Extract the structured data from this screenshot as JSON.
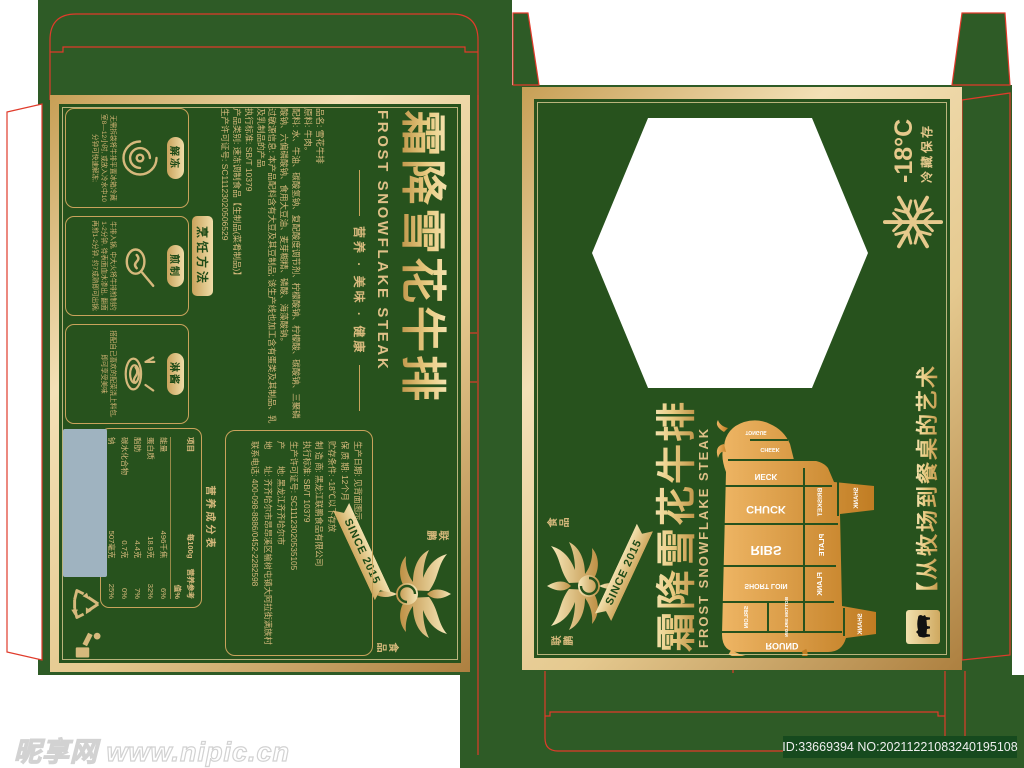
{
  "watermarks": {
    "site": "昵享网 www.nipic.cn",
    "stock_id": "ID:33669394 NO:20211221083240195108"
  },
  "brand": {
    "zh_top": "联鹏",
    "zh_bottom": "食品",
    "since": "SINCE 2015"
  },
  "back": {
    "title": "霜降雪花牛排",
    "subtitle": "FROST SNOWFLAKE STEAK",
    "slogan": "营养 · 美味 · 健康",
    "info": "品名: 雪花牛排\n原料: 牛肉。\n配料: 水、牛油、碳酸氢钠、复配酸度调节剂、柠檬酸钠、柠檬酸、碳酸钠、三聚磷酸钠、六偏磷酸钠、食用大豆油、麦芽糊精、磷酸、海藻酸钠。\n过敏源信息: 本产品配料含有大豆及其豆制品; 该生产线也加工含有蛋类及其制品、乳及乳制品的产品\n执行标准: SB/T 10379\n产品类别: 速冻调制食品【生制品(菜肴制品)】\n生产许可证号: SC11123020506529",
    "manufacturer": "生产日期: 见背面图示\n保 质 期: 12个月\n贮存条件: -18℃以下存放\n制 造 商: 黑龙江联鹏食品有限公司\n执行标准: SB/T 10379\n生产许可证号: SC11123020535105\n产　　地: 黑龙江齐齐哈尔市\n地　　址: 齐齐哈尔市昂昂溪区榆树屯镇大阿拉街满族村\n联系电话: 400-098-8886/0452-2282598",
    "cooking_label": "烹饪方法",
    "steps": [
      {
        "name": "解冻",
        "text": "无需拆袋将牛排平置冰箱冷藏室8—12小时, 或放入冷水中10分钟可快速解冻;"
      },
      {
        "name": "煎制",
        "text": "牛排入锅, 中大火将牛排煎制约1-2分钟, 待表面血水渗出, 翻面再煎1-2分钟, 约7成熟即可出锅;"
      },
      {
        "name": "淋酱",
        "text": "搭配自己喜欢的配菜浇上料包, 即可享受美味"
      }
    ],
    "nutrition_title": "营养成分表",
    "nutrition_rows": [
      [
        "项目",
        "每100g",
        "营养参考值%"
      ],
      [
        "能量",
        "496千焦",
        "6%"
      ],
      [
        "蛋白质",
        "18.9克",
        "32%"
      ],
      [
        "脂肪",
        "4.4克",
        "7%"
      ],
      [
        "碳水化合物",
        "0.7克",
        "0%"
      ],
      [
        "钠",
        "507毫克",
        "25%"
      ]
    ]
  },
  "front": {
    "title": "霜降雪花牛排",
    "subtitle": "FROST SNOWFLAKE STEAK",
    "tagline": "【从牧场到餐桌的艺术",
    "temp": "-18°C",
    "storage": "冷藏保存",
    "cuts": [
      "TONGUE",
      "CHEEK",
      "NECK",
      "CHUCK",
      "BRISKET",
      "SHANK",
      "RIBS",
      "PLATE",
      "SHORT LOIN",
      "FLANK",
      "SIRLOIN",
      "BOTTOM SIRLOIN",
      "ROUND",
      "SHANK"
    ]
  },
  "colors": {
    "panel_green": "#27521d",
    "flap_green": "#2e5b26",
    "gold": "#d6b97c",
    "dieline_red": "#e03b2b",
    "barcode_gray": "#9fb3c0"
  }
}
